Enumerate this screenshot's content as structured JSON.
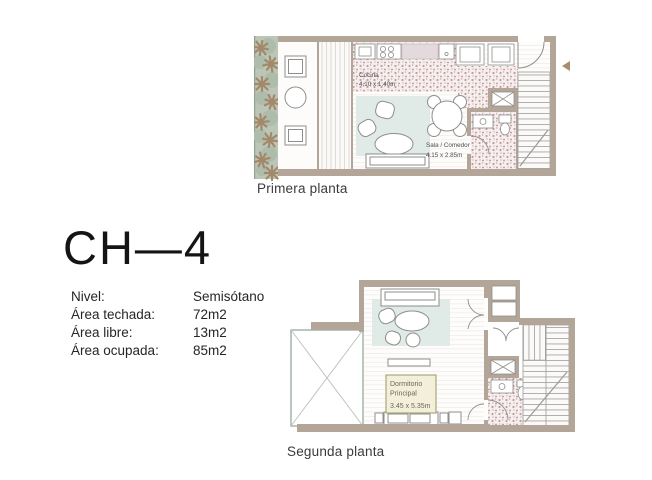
{
  "unit": {
    "title": "CH—4"
  },
  "info": {
    "rows": [
      {
        "label": "Nivel:",
        "value": "Semisótano"
      },
      {
        "label": "Área techada:",
        "value": "72m2"
      },
      {
        "label": "Área libre:",
        "value": "13m2"
      },
      {
        "label": "Área ocupada:",
        "value": "85m2"
      }
    ]
  },
  "plans": [
    {
      "caption": "Primera planta",
      "rooms": [
        {
          "name": "Cocina",
          "dimensions": "4.10 x 1.40m"
        },
        {
          "name": "Sala / Comedor",
          "dimensions": "4.15 x 2.85m"
        }
      ]
    },
    {
      "caption": "Segunda planta",
      "rooms": [
        {
          "name": "Dormitorio Principal",
          "name_lines": [
            "Dormitorio",
            "Principal"
          ],
          "dimensions": "3.45 x 5.35m"
        }
      ]
    }
  ],
  "icons": {
    "entrance_arrow": "left-pointing-triangle",
    "plant": "asterisk-shrub",
    "stairs": "tread-lines-with-diagonal",
    "shaft": "box-with-x",
    "door": "quarter-circle-arc"
  },
  "colors": {
    "wall": "#b3a597",
    "floor_stipple_dot": "#c49a9a",
    "stipple_bg": "#f6efef",
    "garden": "#bcc6b6",
    "bush": "#aebcab",
    "plant": "#a3886a",
    "rug": "#e0eae6",
    "counter": "#e4dade",
    "furniture_line": "#8e8e8c",
    "label_box_bg": "#f3efdb",
    "label_box_border": "#a8a87a",
    "void_border": "#a2b5aa",
    "text": "#262626",
    "plan_text": "#4f4f4d"
  }
}
